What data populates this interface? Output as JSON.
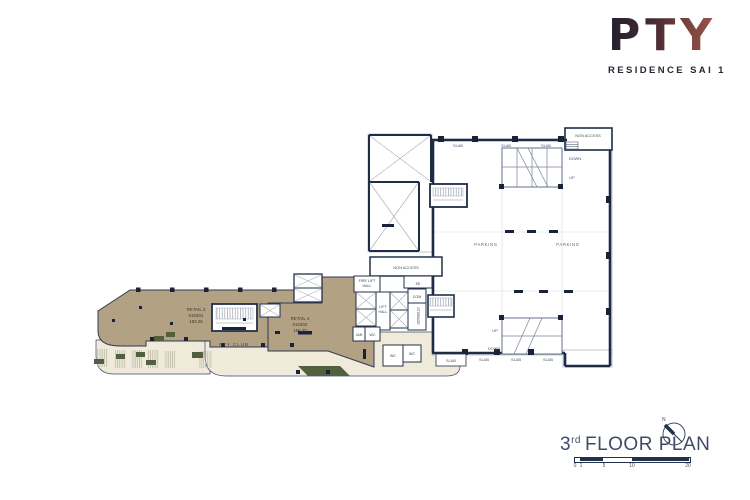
{
  "logo": {
    "title": "PTY",
    "subtitle": "RESIDENCE SAI 1"
  },
  "plan": {
    "retail3": {
      "name": "RETAIL 3",
      "unit": "010301",
      "area": "183.25"
    },
    "retail4": {
      "name": "RETAIL 4",
      "unit": "010302",
      "area": "156.70"
    },
    "pty_club": "PTY CLUB",
    "parking": "PARKING",
    "slab": "SLAB",
    "non_access": "NON ACCESS",
    "down": "DOWN",
    "up": "UP",
    "fire_lift_line1": "FIRE LIFT",
    "fire_lift_line2": "HALL",
    "lift_line1": "LIFT",
    "lift_line2": "HALL",
    "com": "COM",
    "storage": "STORAGE",
    "jan": "JAN",
    "wc": "WC",
    "ee": "EE"
  },
  "footer": {
    "floor_number": "3",
    "floor_suffix": "rd",
    "floor_title": "FLOOR PLAN",
    "north_letter": "N",
    "scale": [
      "0",
      "1",
      "5",
      "10",
      "20"
    ]
  },
  "colors": {
    "wall": "#1f2c45",
    "retail_tan": "#b2a183",
    "walkway_cream": "#efead9",
    "planter_green": "#52603f",
    "logo_dark": "#241f2e",
    "logo_red": "#9b564e"
  }
}
